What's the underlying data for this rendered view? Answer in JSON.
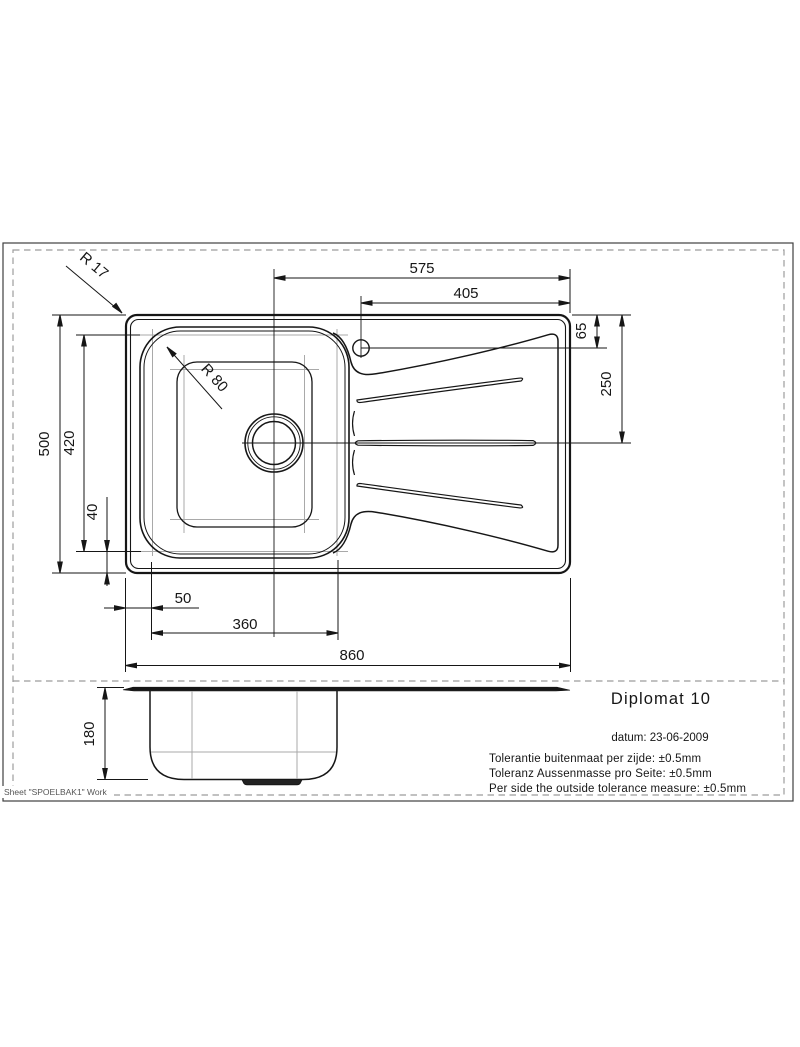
{
  "sheet": {
    "work_label": "Sheet \"SPOELBAK1\" Work"
  },
  "title_block": {
    "product_name": "Diplomat 10",
    "date": "datum: 23-06-2009",
    "tolerances": [
      "Tolerantie buitenmaat per zijde: ±0.5mm",
      "Toleranz Aussenmasse pro Seite: ±0.5mm",
      "Per side the outside tolerance measure: ±0.5mm"
    ]
  },
  "dimensions": {
    "drain_to_right_edge": "575",
    "taphole_to_right_edge": "405",
    "taphole_offset_top": "65",
    "top_edge_to_axis": "250",
    "overall_depth": "500",
    "bowl_depth": "420",
    "bowl_bottom_gap": "40",
    "bowl_left_gap": "50",
    "bowl_width": "360",
    "overall_width": "860",
    "overall_height": "180",
    "rim_corner_radius": "R 17",
    "bowl_corner_radius": "R 80"
  }
}
